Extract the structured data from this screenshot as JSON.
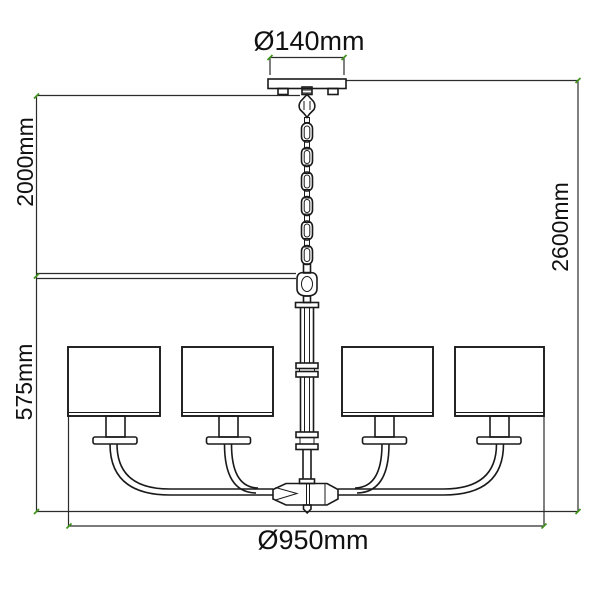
{
  "drawing": {
    "kind": "chandelier-dimension-diagram",
    "shade_count": 4,
    "dimensions": {
      "canopy_diameter": "Ø140mm",
      "chain_length": "2000mm",
      "fixture_height": "575mm",
      "overall_height": "2600mm",
      "fixture_diameter": "Ø950mm"
    },
    "colors": {
      "line": "#1a1a1a",
      "dimension_line": "#2b2b2b",
      "tick": "#43941d",
      "text": "#111111",
      "background": "#ffffff"
    }
  }
}
